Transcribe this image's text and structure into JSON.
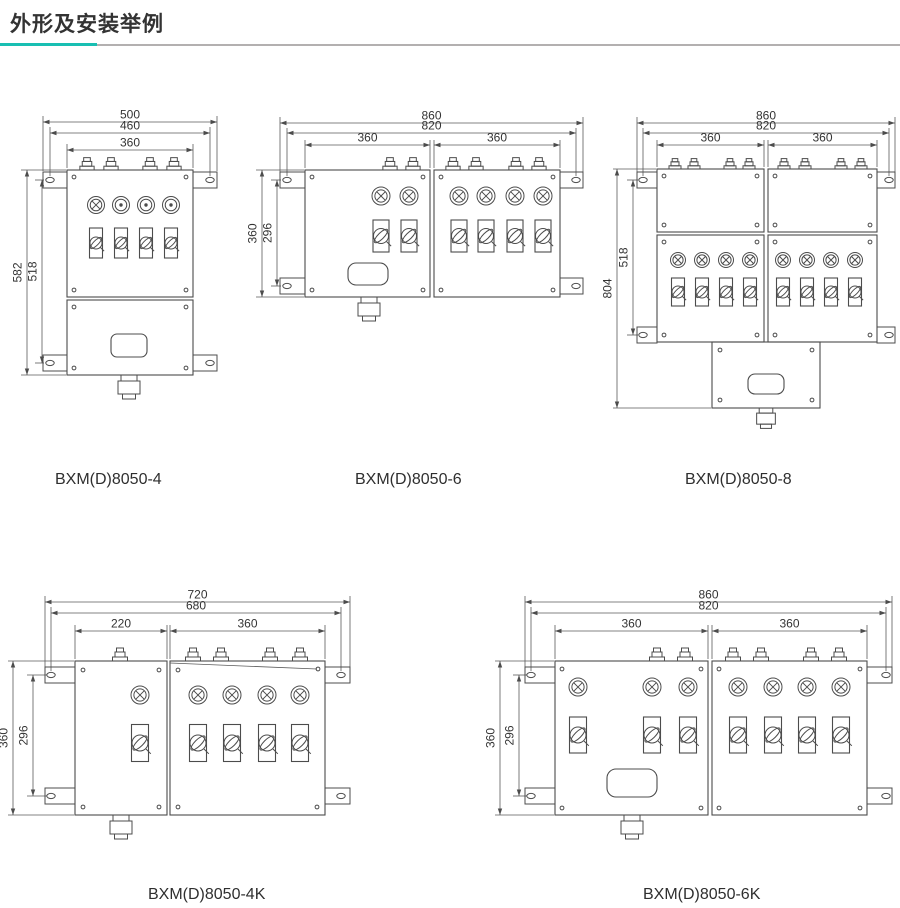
{
  "header": {
    "title": "外形及安装举例"
  },
  "colors": {
    "accent": "#18bfb2",
    "rule_gray": "#b3b0b0",
    "line": "#4c4c4c",
    "text": "#333333"
  },
  "drawings": {
    "d4": {
      "caption": "BXM(D)8050-4",
      "h_dims": [
        "500",
        "460",
        "360"
      ],
      "v_dims": [
        "582",
        "518"
      ]
    },
    "d6": {
      "caption": "BXM(D)8050-6",
      "h_dims": [
        "860",
        "820",
        "360",
        "360"
      ],
      "v_dims": [
        "360",
        "296"
      ]
    },
    "d8": {
      "caption": "BXM(D)8050-8",
      "h_dims": [
        "860",
        "820",
        "360",
        "360"
      ],
      "v_dims": [
        "804",
        "518"
      ]
    },
    "d4k": {
      "caption": "BXM(D)8050-4K",
      "h_dims": [
        "720",
        "680",
        "220",
        "360"
      ],
      "v_dims": [
        "360",
        "296"
      ]
    },
    "d6k": {
      "caption": "BXM(D)8050-6K",
      "h_dims": [
        "860",
        "820",
        "360",
        "360"
      ],
      "v_dims": [
        "360",
        "296"
      ]
    }
  }
}
